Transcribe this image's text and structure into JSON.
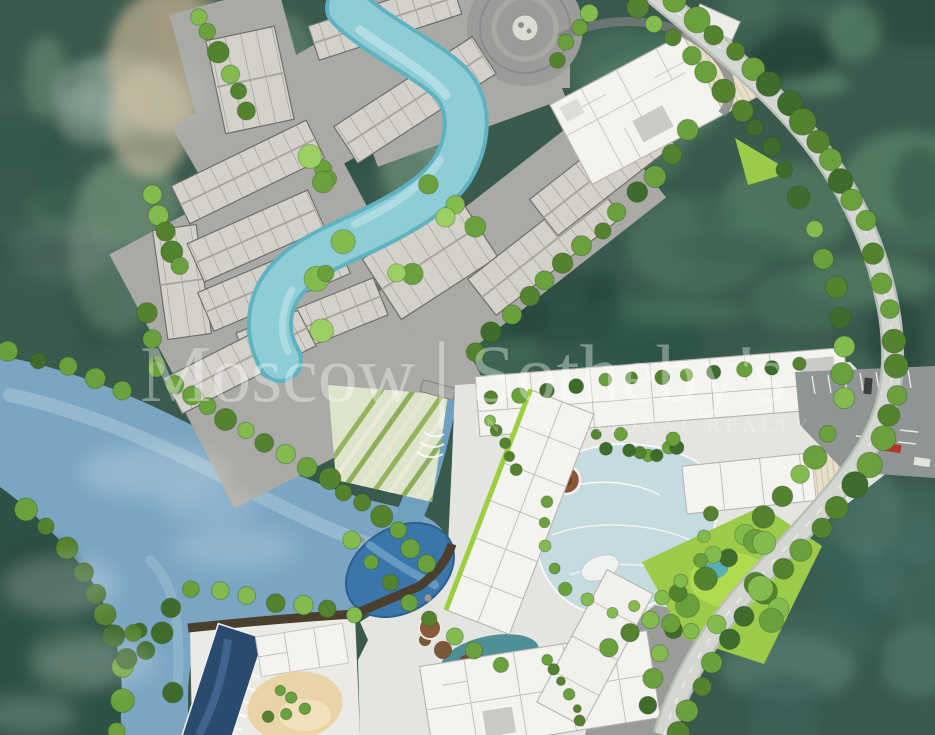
{
  "watermark": {
    "brand_left": "Moscow",
    "separator": "|",
    "brand_right": "Sotheby's",
    "subtitle": "INTERNATIONAL REALTY",
    "color": "rgba(255,255,255,0.36)",
    "subtitle_color": "rgba(255,255,255,0.27)"
  },
  "palette": {
    "forest_base": "#3a5a4e",
    "forest_dark": "#2c4c41",
    "river": "#7ba6c3",
    "river_light": "#a9c6d6",
    "road": "#d4d7d1",
    "complex_paving": "#a9aaa6",
    "plaza": "#9b9b99",
    "building_gray": "#d3d1ca",
    "building_white": "#f4f3f0",
    "pool_turquoise": "#8ecdd6",
    "lagoon": "#c6dbe0",
    "natural_pool": "#3b76aa",
    "lap_pool": "#2a4a6e",
    "sand": "#e8d4a6",
    "spa_brown": "#8a5637",
    "lawn": "#9ccb4a",
    "parking": "#8f9592",
    "car_red": "#b5342a",
    "cliff_tan": "#b3a78c",
    "tree_green": "#54822f"
  }
}
